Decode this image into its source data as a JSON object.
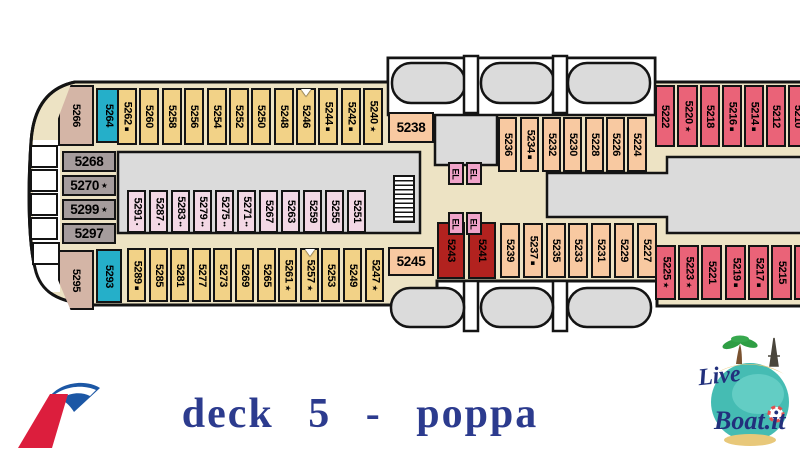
{
  "title": "deck 5 - poppa",
  "title_color": "#2c3b8e",
  "liveboat": {
    "line1": "Live",
    "line2": "Boat.it",
    "text_color": "#22307c"
  },
  "palette": {
    "yellow": "#f2d287",
    "salmon": "#f8c9a1",
    "red": "#ea6378",
    "darkred": "#b2221f",
    "cyan": "#25afc9",
    "pink": "#f3d8e5",
    "gray": "#a59c9c",
    "tan": "#d4b5a6",
    "el": "#f0a3c9",
    "floor": "#ede3c4",
    "block": "#dbdbdb",
    "outline": "#141414"
  },
  "deck": {
    "cabins": [
      {
        "label": "5266",
        "c": "tan",
        "x": 58,
        "y": 85,
        "w": 36,
        "h": 61,
        "clip": "tl"
      },
      {
        "label": "5264",
        "c": "cyan",
        "x": 96,
        "y": 88,
        "w": 25,
        "h": 55
      },
      {
        "label": "5262",
        "s": "■",
        "c": "yellow",
        "x": 117,
        "y": 88,
        "w": 20,
        "h": 57
      },
      {
        "label": "5260",
        "c": "yellow",
        "x": 139,
        "y": 88,
        "w": 20,
        "h": 57
      },
      {
        "label": "5258",
        "c": "yellow",
        "x": 162,
        "y": 88,
        "w": 20,
        "h": 57
      },
      {
        "label": "5256",
        "c": "yellow",
        "x": 184,
        "y": 88,
        "w": 20,
        "h": 57
      },
      {
        "label": "5254",
        "c": "yellow",
        "x": 207,
        "y": 88,
        "w": 20,
        "h": 57
      },
      {
        "label": "5252",
        "c": "yellow",
        "x": 229,
        "y": 88,
        "w": 20,
        "h": 57
      },
      {
        "label": "5250",
        "c": "yellow",
        "x": 251,
        "y": 88,
        "w": 20,
        "h": 57
      },
      {
        "label": "5248",
        "c": "yellow",
        "x": 274,
        "y": 88,
        "w": 20,
        "h": 57
      },
      {
        "label": "5246",
        "t": 1,
        "c": "yellow",
        "x": 296,
        "y": 88,
        "w": 20,
        "h": 57
      },
      {
        "label": "5244",
        "s": "■",
        "c": "yellow",
        "x": 318,
        "y": 88,
        "w": 20,
        "h": 57
      },
      {
        "label": "5242",
        "s": "■",
        "c": "yellow",
        "x": 341,
        "y": 88,
        "w": 20,
        "h": 57
      },
      {
        "label": "5240",
        "s": "★",
        "c": "yellow",
        "x": 363,
        "y": 88,
        "w": 20,
        "h": 57
      },
      {
        "label": "5238",
        "c": "salmon",
        "x": 388,
        "y": 112,
        "w": 46,
        "h": 31,
        "o": "h"
      },
      {
        "label": "5236",
        "c": "salmon",
        "x": 498,
        "y": 117,
        "w": 19,
        "h": 55
      },
      {
        "label": "5234",
        "s": "■",
        "c": "salmon",
        "x": 520,
        "y": 117,
        "w": 19,
        "h": 55
      },
      {
        "label": "5232",
        "c": "salmon",
        "x": 542,
        "y": 117,
        "w": 19,
        "h": 55
      },
      {
        "label": "5230",
        "c": "salmon",
        "x": 563,
        "y": 117,
        "w": 19,
        "h": 55
      },
      {
        "label": "5228",
        "c": "salmon",
        "x": 585,
        "y": 117,
        "w": 19,
        "h": 55
      },
      {
        "label": "5226",
        "c": "salmon",
        "x": 606,
        "y": 117,
        "w": 19,
        "h": 55
      },
      {
        "label": "5224",
        "c": "salmon",
        "x": 627,
        "y": 117,
        "w": 20,
        "h": 55
      },
      {
        "label": "5222",
        "c": "red",
        "x": 655,
        "y": 85,
        "w": 20,
        "h": 62
      },
      {
        "label": "5220",
        "s": "★",
        "c": "red",
        "x": 677,
        "y": 85,
        "w": 21,
        "h": 62
      },
      {
        "label": "5218",
        "c": "red",
        "x": 700,
        "y": 85,
        "w": 20,
        "h": 62
      },
      {
        "label": "5216",
        "s": "■",
        "c": "red",
        "x": 722,
        "y": 85,
        "w": 20,
        "h": 62
      },
      {
        "label": "5214",
        "s": "■",
        "c": "red",
        "x": 744,
        "y": 85,
        "w": 20,
        "h": 62
      },
      {
        "label": "5212",
        "c": "red",
        "x": 766,
        "y": 85,
        "w": 20,
        "h": 62
      },
      {
        "label": "5210",
        "c": "red",
        "x": 788,
        "y": 85,
        "w": 20,
        "h": 62
      },
      {
        "label": "5268",
        "c": "gray",
        "x": 62,
        "y": 151,
        "w": 54,
        "h": 21,
        "o": "h"
      },
      {
        "label": "5270",
        "s": "★",
        "c": "gray",
        "x": 62,
        "y": 175,
        "w": 54,
        "h": 21,
        "o": "h"
      },
      {
        "label": "5299",
        "s": "★",
        "c": "gray",
        "x": 62,
        "y": 199,
        "w": 54,
        "h": 21,
        "o": "h"
      },
      {
        "label": "5297",
        "c": "gray",
        "x": 62,
        "y": 223,
        "w": 54,
        "h": 21,
        "o": "h"
      },
      {
        "label": "5291",
        "s": "•",
        "c": "pink",
        "x": 127,
        "y": 190,
        "w": 19,
        "h": 43
      },
      {
        "label": "5287",
        "s": "•",
        "c": "pink",
        "x": 149,
        "y": 190,
        "w": 19,
        "h": 43
      },
      {
        "label": "5283",
        "s": "••",
        "c": "pink",
        "x": 171,
        "y": 190,
        "w": 19,
        "h": 43
      },
      {
        "label": "5279",
        "s": "••",
        "c": "pink",
        "x": 193,
        "y": 190,
        "w": 19,
        "h": 43
      },
      {
        "label": "5275",
        "s": "••",
        "c": "pink",
        "x": 215,
        "y": 190,
        "w": 19,
        "h": 43
      },
      {
        "label": "5271",
        "s": "••",
        "c": "pink",
        "x": 237,
        "y": 190,
        "w": 19,
        "h": 43
      },
      {
        "label": "5267",
        "c": "pink",
        "x": 259,
        "y": 190,
        "w": 19,
        "h": 43
      },
      {
        "label": "5263",
        "c": "pink",
        "x": 281,
        "y": 190,
        "w": 19,
        "h": 43
      },
      {
        "label": "5259",
        "c": "pink",
        "x": 303,
        "y": 190,
        "w": 19,
        "h": 43
      },
      {
        "label": "5255",
        "c": "pink",
        "x": 325,
        "y": 190,
        "w": 19,
        "h": 43
      },
      {
        "label": "5251",
        "c": "pink",
        "x": 347,
        "y": 190,
        "w": 19,
        "h": 43
      },
      {
        "label": "5295",
        "c": "tan",
        "x": 58,
        "y": 250,
        "w": 36,
        "h": 60,
        "clip": "bl"
      },
      {
        "label": "5293",
        "c": "cyan",
        "x": 96,
        "y": 249,
        "w": 26,
        "h": 54
      },
      {
        "label": "5289",
        "s": "■",
        "c": "yellow",
        "x": 127,
        "y": 248,
        "w": 19,
        "h": 54
      },
      {
        "label": "5285",
        "c": "yellow",
        "x": 149,
        "y": 248,
        "w": 19,
        "h": 54
      },
      {
        "label": "5281",
        "c": "yellow",
        "x": 170,
        "y": 248,
        "w": 19,
        "h": 54
      },
      {
        "label": "5277",
        "c": "yellow",
        "x": 192,
        "y": 248,
        "w": 19,
        "h": 54
      },
      {
        "label": "5273",
        "c": "yellow",
        "x": 213,
        "y": 248,
        "w": 19,
        "h": 54
      },
      {
        "label": "5269",
        "c": "yellow",
        "x": 235,
        "y": 248,
        "w": 19,
        "h": 54
      },
      {
        "label": "5265",
        "c": "yellow",
        "x": 257,
        "y": 248,
        "w": 19,
        "h": 54
      },
      {
        "label": "5261",
        "s": "★",
        "c": "yellow",
        "x": 278,
        "y": 248,
        "w": 19,
        "h": 54
      },
      {
        "label": "5257",
        "s": "★",
        "t": 1,
        "c": "yellow",
        "x": 300,
        "y": 248,
        "w": 19,
        "h": 54
      },
      {
        "label": "5253",
        "c": "yellow",
        "x": 321,
        "y": 248,
        "w": 19,
        "h": 54
      },
      {
        "label": "5249",
        "c": "yellow",
        "x": 343,
        "y": 248,
        "w": 19,
        "h": 54
      },
      {
        "label": "5247",
        "s": "★",
        "c": "yellow",
        "x": 365,
        "y": 248,
        "w": 19,
        "h": 54
      },
      {
        "label": "5245",
        "c": "salmon",
        "x": 388,
        "y": 247,
        "w": 46,
        "h": 29,
        "o": "h"
      },
      {
        "label": "5243",
        "c": "darkred",
        "x": 437,
        "y": 222,
        "w": 28,
        "h": 57
      },
      {
        "label": "5241",
        "c": "darkred",
        "x": 468,
        "y": 222,
        "w": 28,
        "h": 57
      },
      {
        "label": "5239",
        "c": "salmon",
        "x": 500,
        "y": 223,
        "w": 20,
        "h": 55
      },
      {
        "label": "5237",
        "s": "■",
        "c": "salmon",
        "x": 523,
        "y": 223,
        "w": 20,
        "h": 55
      },
      {
        "label": "5235",
        "c": "salmon",
        "x": 546,
        "y": 223,
        "w": 20,
        "h": 55
      },
      {
        "label": "5233",
        "c": "salmon",
        "x": 568,
        "y": 223,
        "w": 20,
        "h": 55
      },
      {
        "label": "5231",
        "c": "salmon",
        "x": 591,
        "y": 223,
        "w": 20,
        "h": 55
      },
      {
        "label": "5229",
        "c": "salmon",
        "x": 614,
        "y": 223,
        "w": 20,
        "h": 55
      },
      {
        "label": "5227",
        "c": "salmon",
        "x": 637,
        "y": 223,
        "w": 20,
        "h": 55
      },
      {
        "label": "5225",
        "s": "★",
        "c": "red",
        "x": 655,
        "y": 245,
        "w": 21,
        "h": 55
      },
      {
        "label": "5223",
        "s": "★",
        "c": "red",
        "x": 678,
        "y": 245,
        "w": 21,
        "h": 55
      },
      {
        "label": "5221",
        "c": "red",
        "x": 701,
        "y": 245,
        "w": 21,
        "h": 55
      },
      {
        "label": "5219",
        "s": "■",
        "c": "red",
        "x": 725,
        "y": 245,
        "w": 21,
        "h": 55
      },
      {
        "label": "5217",
        "s": "■",
        "c": "red",
        "x": 748,
        "y": 245,
        "w": 21,
        "h": 55
      },
      {
        "label": "5215",
        "c": "red",
        "x": 771,
        "y": 245,
        "w": 21,
        "h": 55
      },
      {
        "label": "5213",
        "c": "red",
        "x": 794,
        "y": 245,
        "w": 21,
        "h": 55
      }
    ],
    "elevators": [
      {
        "label": "EL",
        "x": 448,
        "y": 162
      },
      {
        "label": "EL",
        "x": 466,
        "y": 162
      },
      {
        "label": "EL",
        "x": 448,
        "y": 212
      },
      {
        "label": "EL",
        "x": 466,
        "y": 212
      }
    ]
  }
}
